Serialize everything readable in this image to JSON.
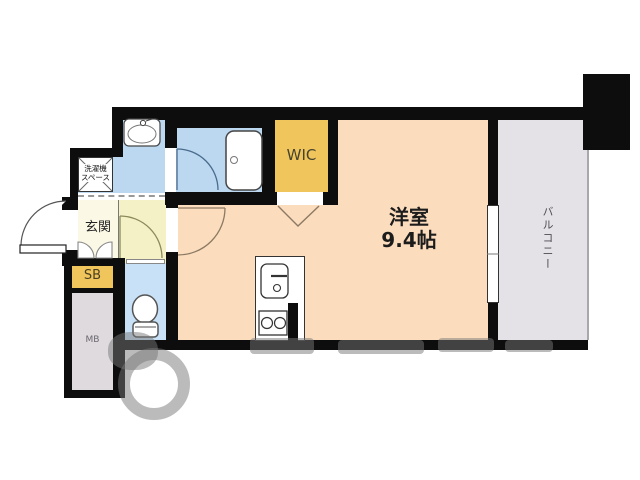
{
  "plan": {
    "rooms": {
      "main": {
        "name": "洋室",
        "size": "9.4帖"
      },
      "wic": {
        "label": "WIC"
      },
      "balcony": {
        "label": "バルコニー"
      },
      "entrance": {
        "label": "玄関"
      },
      "shoe_box": {
        "label": "SB"
      },
      "meter_box": {
        "label": "MB"
      },
      "laundry_space": {
        "line1": "洗濯機",
        "line2": "スペース"
      }
    },
    "fixtures": [
      "washbasin",
      "bathtub",
      "toilet",
      "kitchen-sink",
      "gas-stove",
      "washing-machine-space",
      "window",
      "entrance-door",
      "room-door",
      "hallway-door",
      "bath-door",
      "wic-folding-door",
      "shoe-box-doors"
    ],
    "colors": {
      "wall": "#0d0d0d",
      "room_peach": "#fbdcbd",
      "closet_gold": "#f0c65c",
      "wet_area_blue": "#bcd8f1",
      "toilet_blue": "#c9e1f6",
      "entrance_cream": "#fbf8e6",
      "hallway_yellow": "#f4f1c6",
      "balcony_gray": "#e4e2e6",
      "meter_box_gray": "#dedade"
    }
  }
}
